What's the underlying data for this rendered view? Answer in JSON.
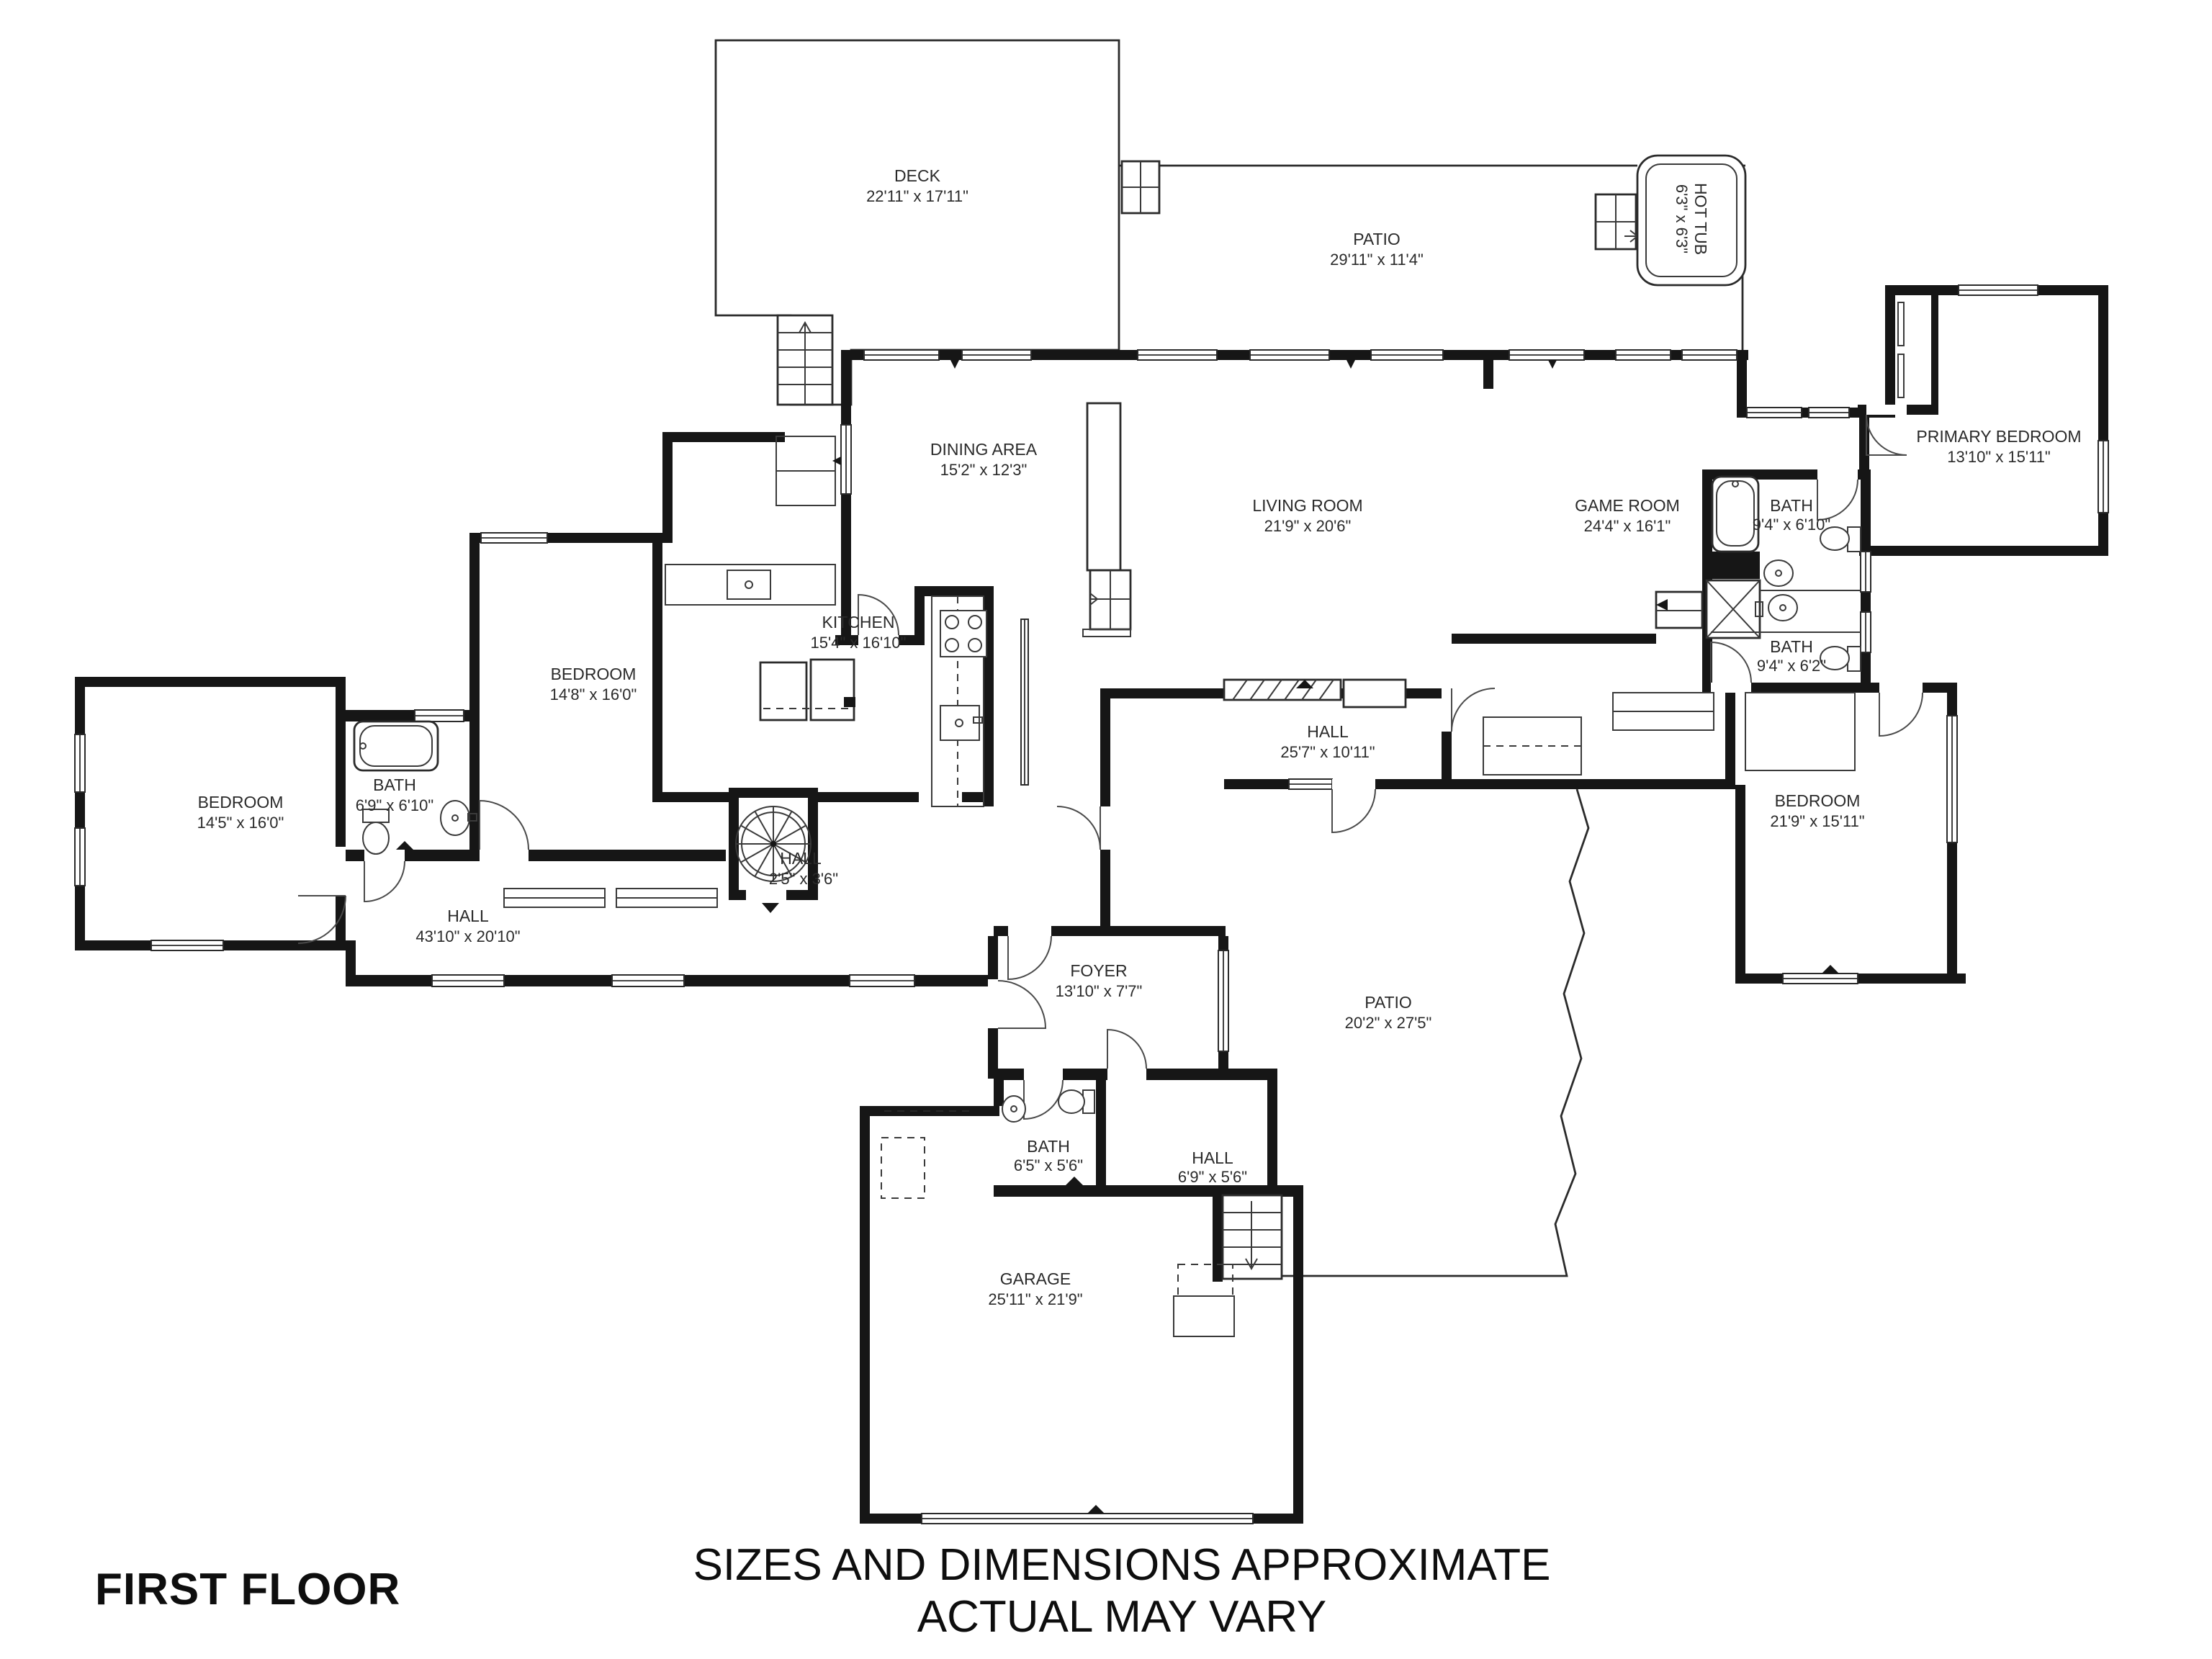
{
  "plan": {
    "floor_title": "FIRST FLOOR",
    "disclaimer_line1": "SIZES AND DIMENSIONS APPROXIMATE",
    "disclaimer_line2": "ACTUAL MAY VARY"
  },
  "rooms": {
    "deck": {
      "name": "DECK",
      "dims": "22'11\" x 17'11\""
    },
    "patio_top": {
      "name": "PATIO",
      "dims": "29'11\" x 11'4\""
    },
    "hot_tub": {
      "name": "HOT TUB",
      "dims": "6'3\" x 6'3\""
    },
    "primary_bedroom": {
      "name": "PRIMARY BEDROOM",
      "dims": "13'10\" x 15'11\""
    },
    "dining_area": {
      "name": "DINING AREA",
      "dims": "15'2\" x 12'3\""
    },
    "living_room": {
      "name": "LIVING ROOM",
      "dims": "21'9\" x 20'6\""
    },
    "game_room": {
      "name": "GAME ROOM",
      "dims": "24'4\" x 16'1\""
    },
    "bath_primary": {
      "name": "BATH",
      "dims": "9'4\" x 6'10\""
    },
    "bath_second": {
      "name": "BATH",
      "dims": "9'4\" x 6'2\""
    },
    "bedroom_right": {
      "name": "BEDROOM",
      "dims": "21'9\" x 15'11\""
    },
    "kitchen": {
      "name": "KITCHEN",
      "dims": "15'4\" x 16'10\""
    },
    "bedroom_mid": {
      "name": "BEDROOM",
      "dims": "14'8\" x 16'0\""
    },
    "bedroom_left": {
      "name": "BEDROOM",
      "dims": "14'5\" x 16'0\""
    },
    "bath_left": {
      "name": "BATH",
      "dims": "6'9\" x 6'10\""
    },
    "hall_left": {
      "name": "HALL",
      "dims": "43'10\" x 20'10\""
    },
    "hall_stair": {
      "name": "HALL",
      "dims": "2'5\" x 3'6\""
    },
    "hall_mid": {
      "name": "HALL",
      "dims": "25'7\" x 10'11\""
    },
    "foyer": {
      "name": "FOYER",
      "dims": "13'10\" x 7'7\""
    },
    "patio_bottom": {
      "name": "PATIO",
      "dims": "20'2\" x 27'5\""
    },
    "bath_bottom": {
      "name": "BATH",
      "dims": "6'5\" x 5'6\""
    },
    "hall_bottom": {
      "name": "HALL",
      "dims": "6'9\" x 5'6\""
    },
    "garage": {
      "name": "GARAGE",
      "dims": "25'11\" x 21'9\""
    }
  },
  "colors": {
    "wall": "#161616",
    "line": "#2b2b2b",
    "text": "#2a2a2a",
    "background": "#ffffff"
  }
}
